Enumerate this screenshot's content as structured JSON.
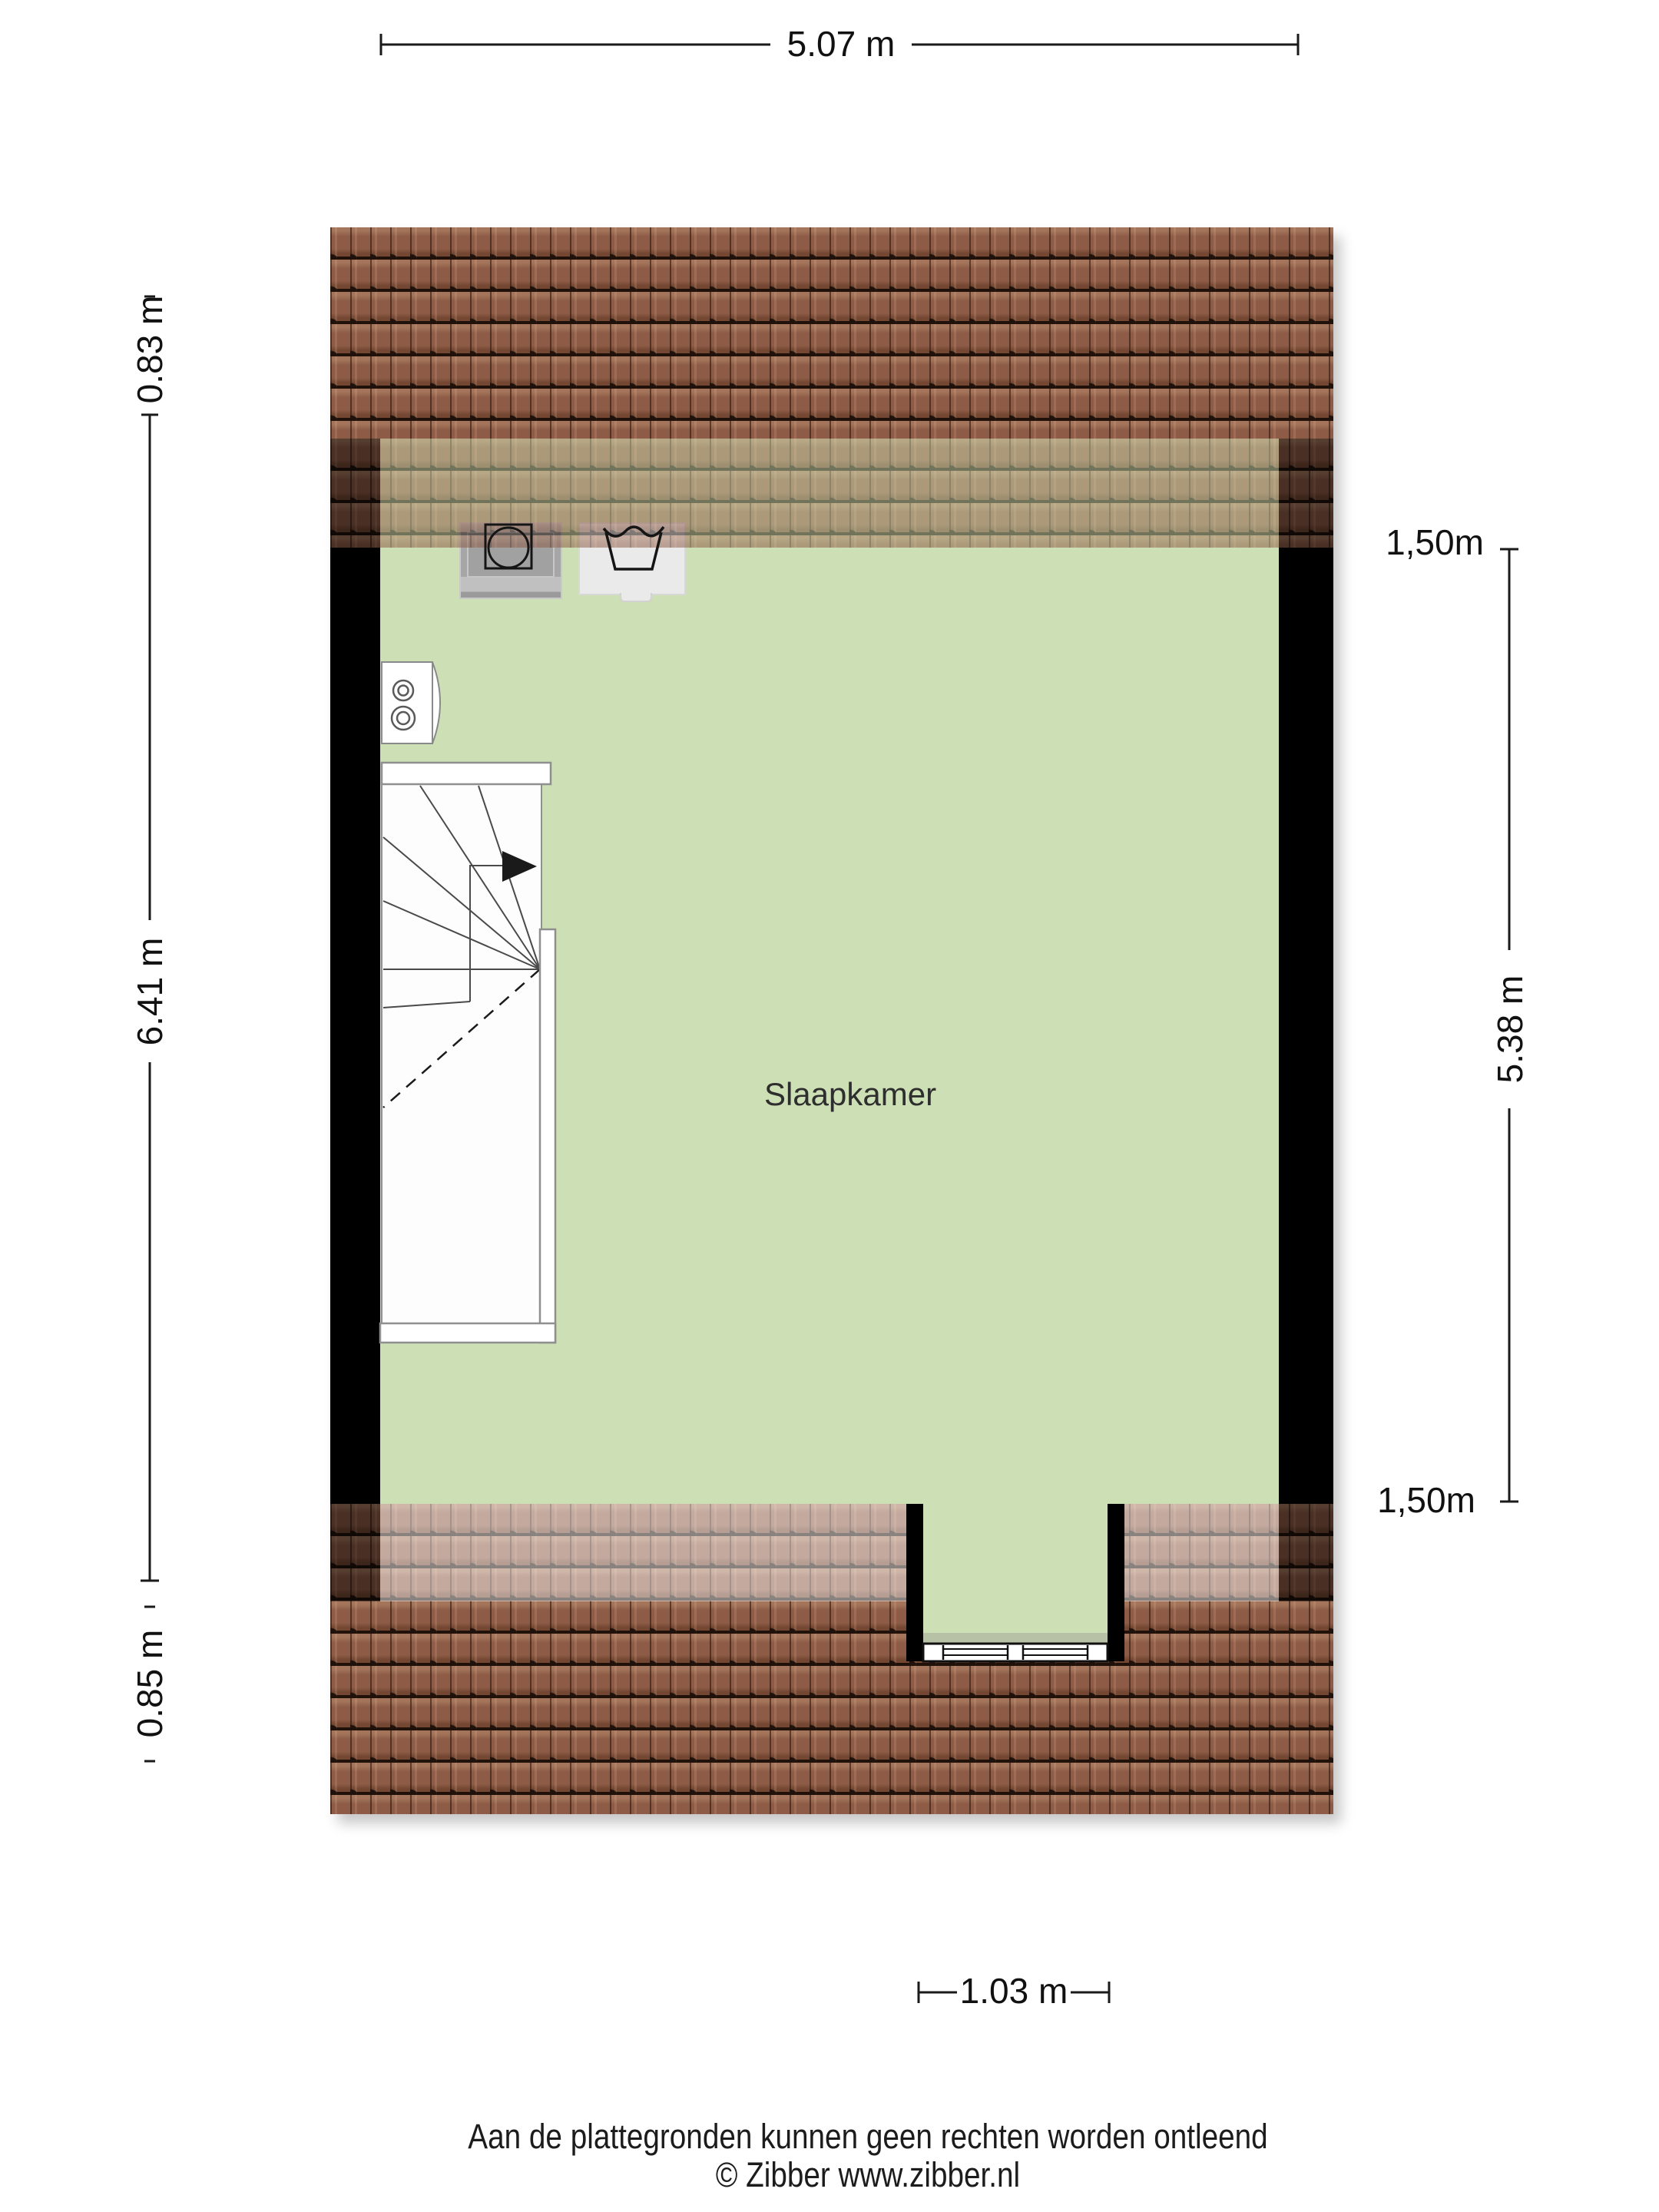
{
  "floorplan": {
    "room": {
      "label": "Slaapkamer"
    },
    "dimensions": {
      "top_width": "5.07 m",
      "left_roof_top": "0.83 m",
      "left_room_depth": "6.41 m",
      "left_roof_bottom": "0.85 m",
      "right_height_line_top": "1,50m",
      "right_room_depth": "5.38 m",
      "right_height_line_bottom": "1,50m",
      "bottom_dormer_width": "1.03 m"
    },
    "icons": [
      "washing-machine-icon",
      "laundry-tub-icon",
      "boiler-icon",
      "staircase-with-up-arrow",
      "dormer-window"
    ],
    "colors": {
      "floor": "#cddfb4",
      "roof_tile": "#8d5b46",
      "roof_tile_dark": "#20120b",
      "wall": "#000000",
      "stairs_fill": "#ffffff",
      "dimension_text": "#111111"
    }
  },
  "footer": {
    "disclaimer": "Aan de plattegronden kunnen geen rechten worden ontleend",
    "copyright": "© Zibber www.zibber.nl"
  }
}
